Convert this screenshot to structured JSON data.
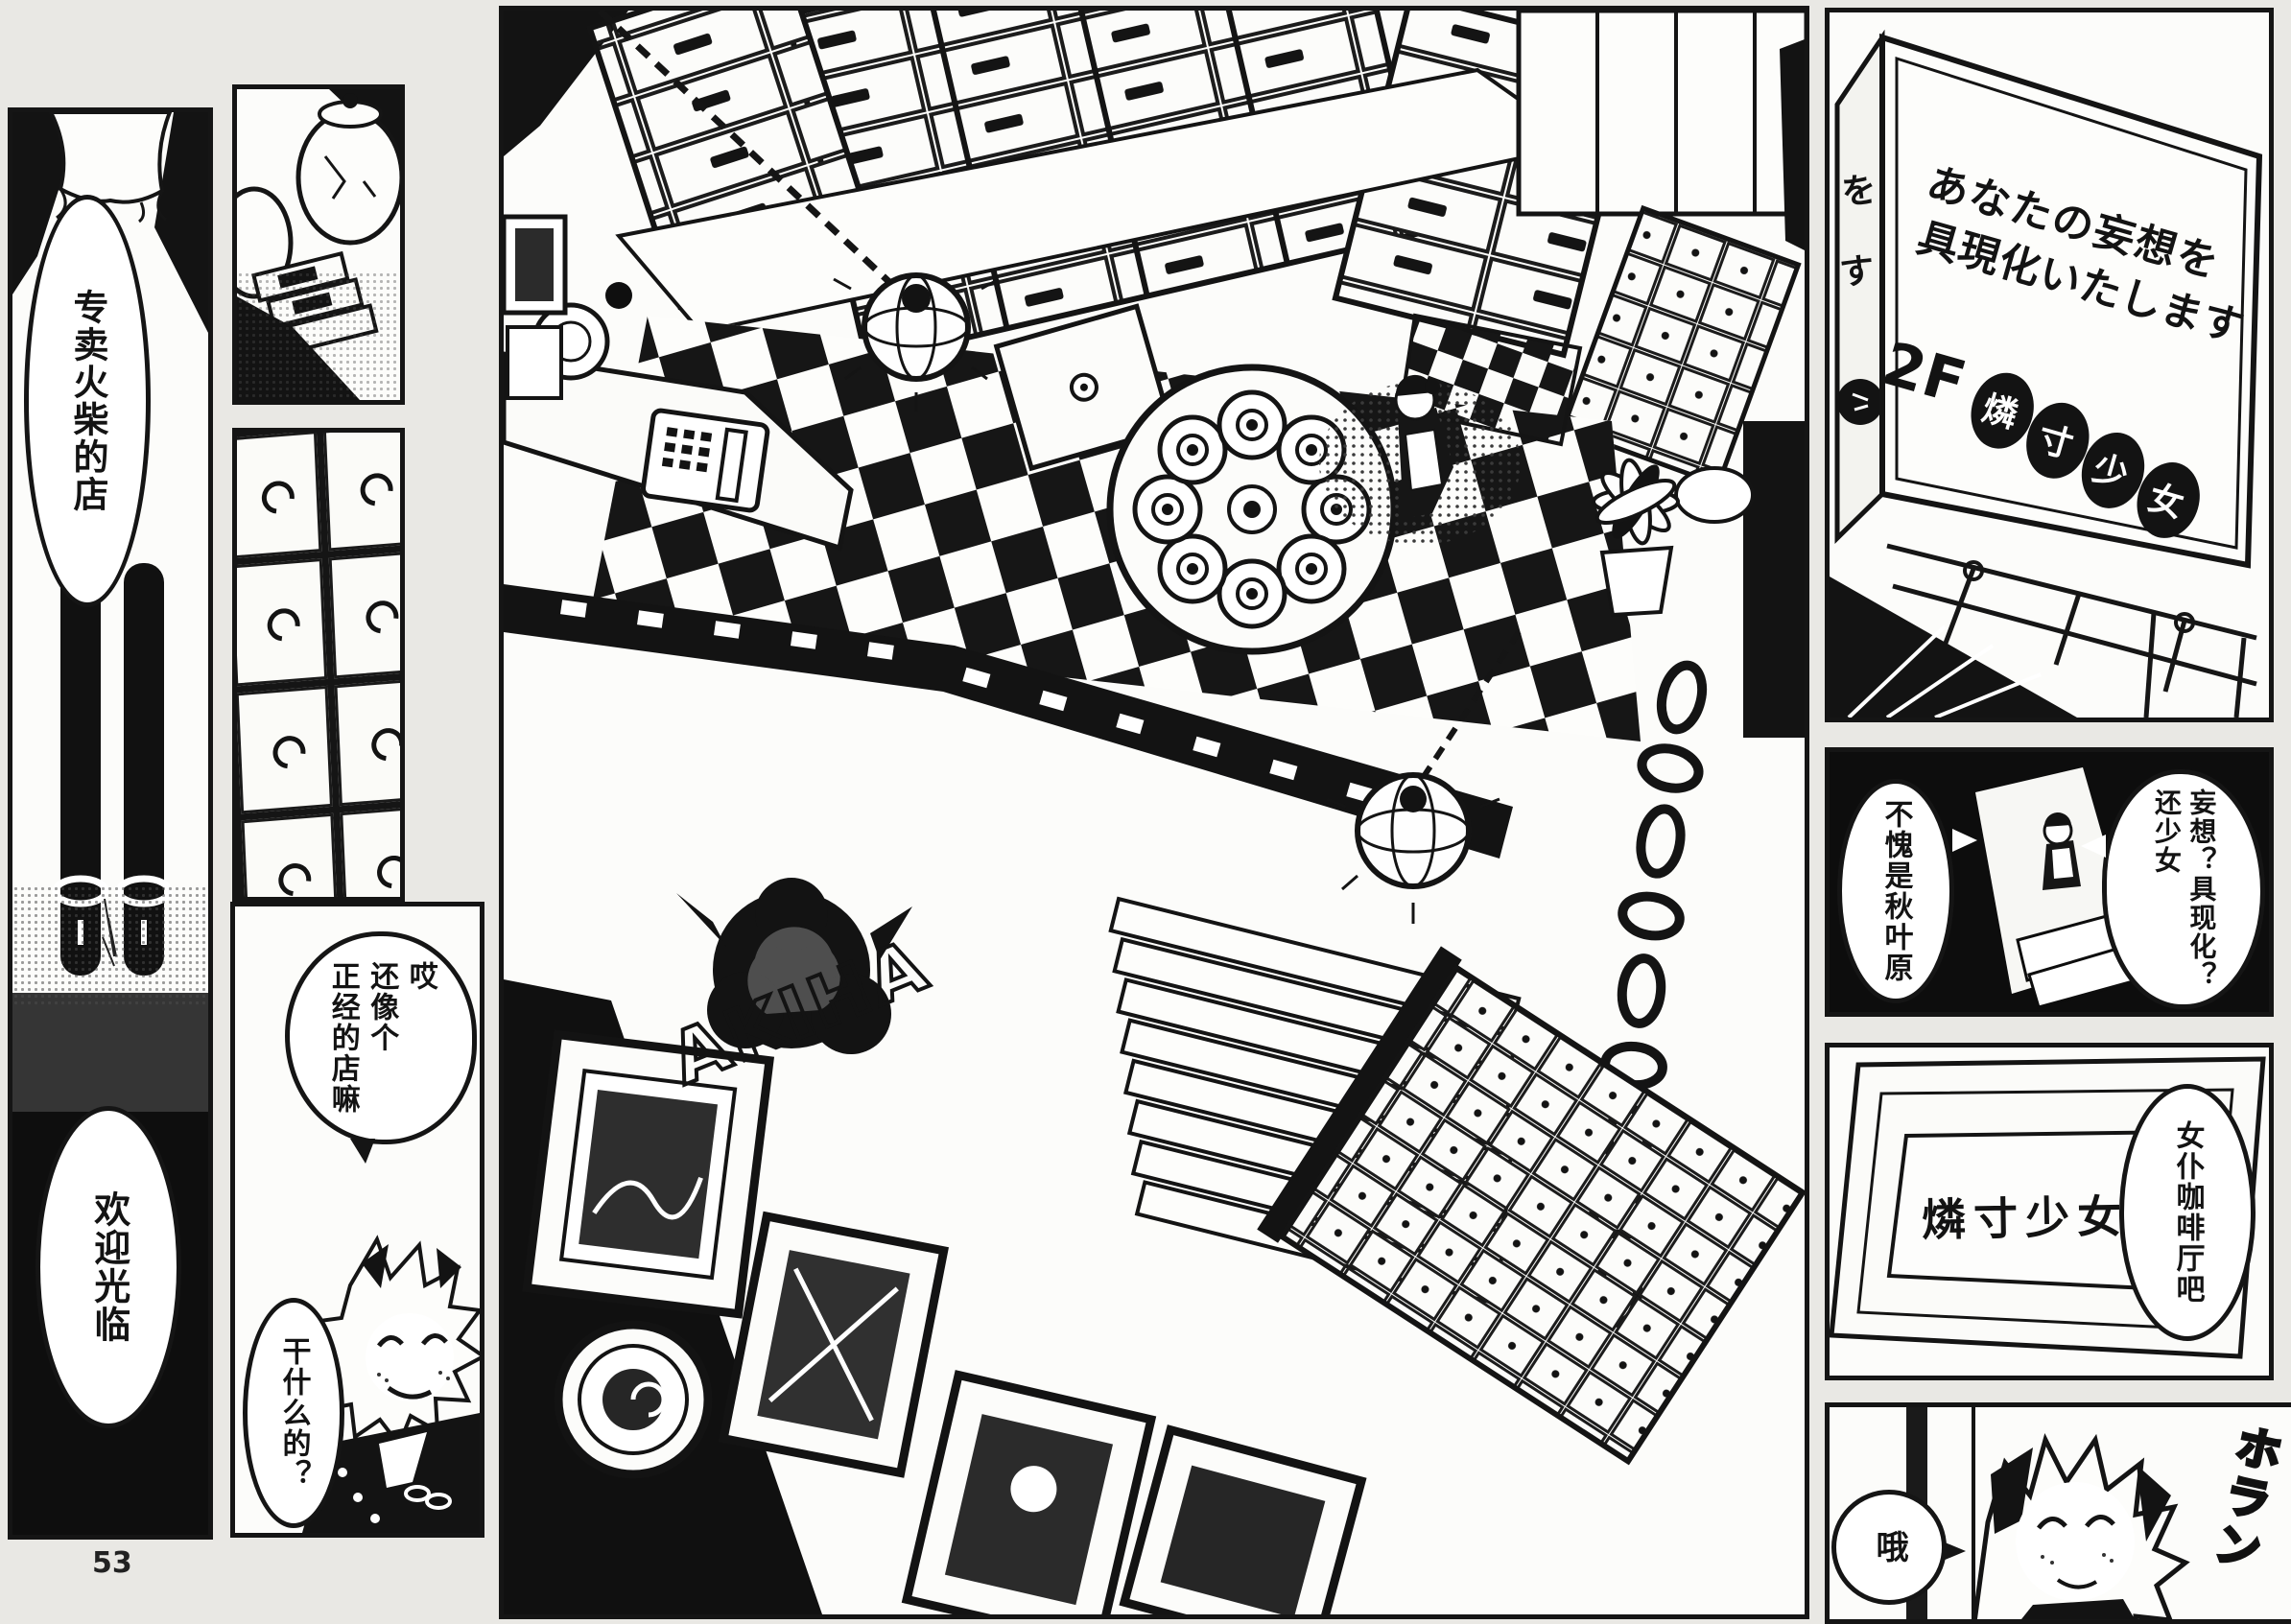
{
  "page": {
    "number": "53",
    "ink_color": "#151515",
    "paper_color": "#e9e8e4"
  },
  "left_panel": {
    "bubble_store": "专卖火柴的店",
    "bubble_welcome": "欢迎光临"
  },
  "col2": {
    "bubble_remark": "哎\n还像个\n正经的店嘛",
    "bubble_what": "干什么的？"
  },
  "center_panel": {
    "splat_logo": "AKIHA"
  },
  "right_panel": {
    "billboard": {
      "line1": "あなたの妄想を",
      "line2": "具現化いたします",
      "floor": "2F",
      "name_chars": [
        "燐",
        "寸",
        "少",
        "女"
      ],
      "side_char1": "を",
      "side_char2": "す"
    },
    "dark_panel": {
      "bubble_left": "不愧是秋叶原",
      "bubble_right": "妄想？具现化？\n还少女"
    },
    "floor_sign": {
      "name": "燐寸少女",
      "bubble": "女仆咖啡厅吧"
    },
    "bottom": {
      "bubble": "哦",
      "sfx": "ホラン"
    }
  }
}
